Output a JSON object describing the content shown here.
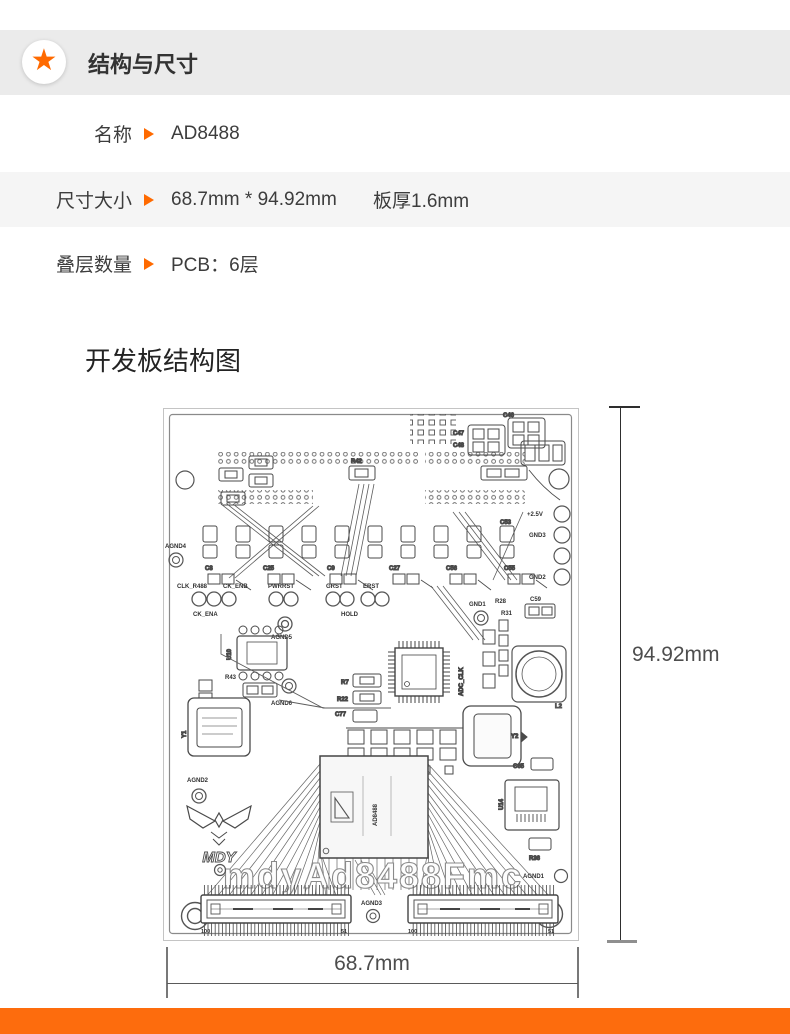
{
  "colors": {
    "accent": "#ff6a00",
    "footer_bar": "#fd6c0d",
    "header_bar_bg": "#ebebeb",
    "row_alt_bg": "#f5f5f5"
  },
  "header": {
    "title": "结构与尺寸",
    "star_icon": "★"
  },
  "specs": [
    {
      "label": "名称",
      "value": "AD8488",
      "value2": ""
    },
    {
      "label": "尺寸大小",
      "value": "68.7mm * 94.92mm",
      "value2": "板厚1.6mm"
    },
    {
      "label": "叠层数量",
      "value": "PCB：6层",
      "value2": ""
    }
  ],
  "diagram": {
    "heading": "开发板结构图",
    "height_label": "94.92mm",
    "width_label": "68.7mm"
  },
  "pcb": {
    "labels": {
      "agnd1": "AGND1",
      "agnd2": "AGND2",
      "agnd3": "AGND3",
      "agnd4": "AGND4",
      "agnd5": "AGND5",
      "agnd6": "AGND6",
      "gnd1": "GND1",
      "gnd2": "GND2",
      "gnd3": "GND3",
      "p25v": "+2.5V",
      "clk_r488": "CLK_R488",
      "ck_enb": "CK_ENB",
      "ck_ena": "CK_ENA",
      "pwrrst": "PWRRST",
      "grst": "GRST",
      "erst": "ERST",
      "hold": "HOLD",
      "c8": "C8",
      "c25": "C25",
      "c9": "C9",
      "c27": "C27",
      "c56": "C56",
      "c55": "C55",
      "c53": "C53",
      "c46": "C46",
      "c47": "C47",
      "c48": "C48",
      "c59": "C59",
      "c65": "C65",
      "c77": "C77",
      "r42": "R42",
      "r43": "R43",
      "r7": "R7",
      "r22": "R22",
      "r28": "R28",
      "r31": "R31",
      "r36": "R36",
      "u10": "U10",
      "u14": "U14",
      "y1": "Y1",
      "y2": "Y2",
      "l2": "L2",
      "adc_clk": "ADC_CLK",
      "chip": "AD8488",
      "pin100": "100",
      "pin51": "51",
      "logo": "MDY",
      "watermark": "mdyAd8488Fmc"
    }
  }
}
